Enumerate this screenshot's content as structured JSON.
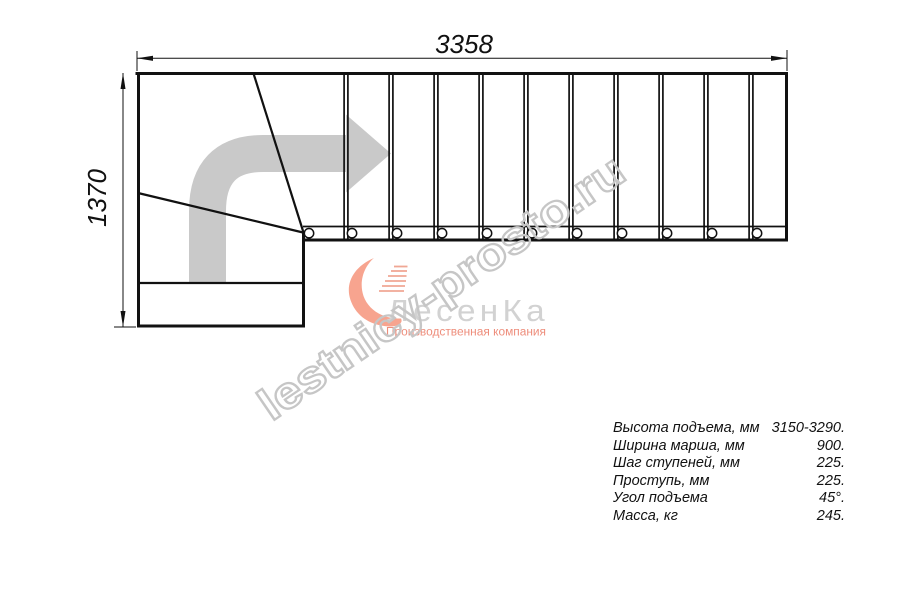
{
  "drawing": {
    "title": "staircase-top-view-plan",
    "width_dim_label": "3358",
    "height_dim_label": "1370",
    "colors": {
      "line": "#111111",
      "direction_arrow_gray": "#c9c9c9",
      "watermark_gray": "#c6c6c6",
      "logo_text_gray": "#d2d2d2",
      "logo_salmon": "#ee8d7b"
    }
  },
  "watermark": {
    "text": "lestnicy-prosto.ru"
  },
  "logo": {
    "name": "ЛесенКа",
    "tagline": "Производственная компания",
    "mark": "swoosh-stairs-icon"
  },
  "specs": {
    "rows": [
      {
        "label": "Высота подъема, мм",
        "value": "3150-3290."
      },
      {
        "label": "Ширина марша, мм",
        "value": "900."
      },
      {
        "label": "Шаг ступеней, мм",
        "value": "225."
      },
      {
        "label": "Проступь, мм",
        "value": "225."
      },
      {
        "label": "Угол подъема",
        "value": "45°."
      },
      {
        "label": "Масса, кг",
        "value": "245."
      }
    ]
  }
}
